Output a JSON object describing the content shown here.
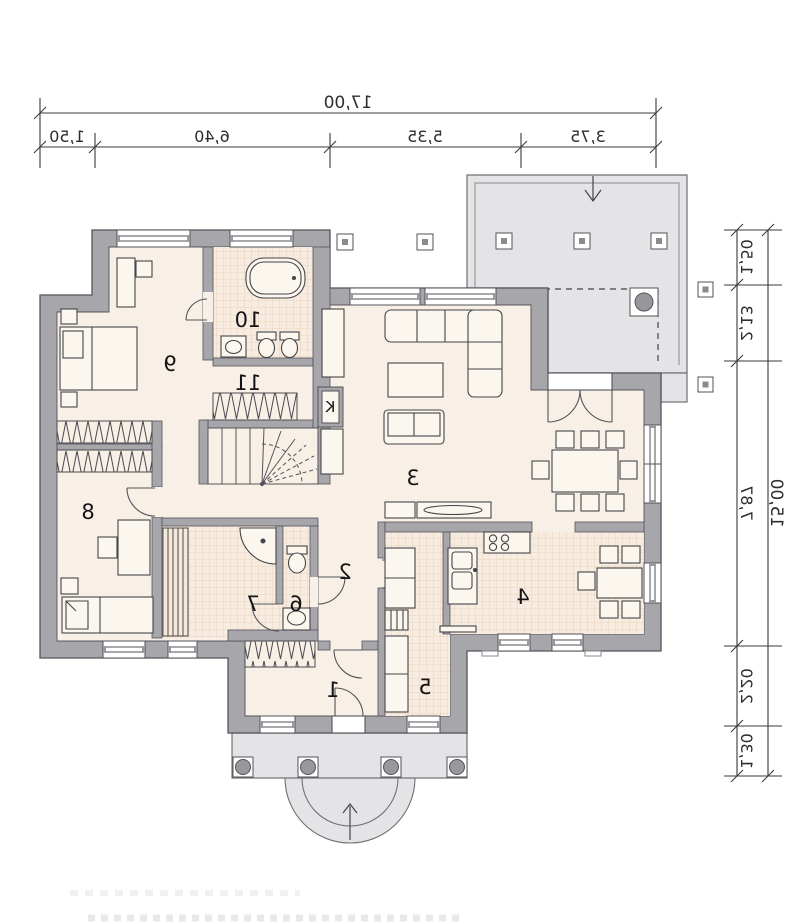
{
  "plan": {
    "type": "house-floor-plan",
    "mirrored": true,
    "rooms": {
      "r1": "1",
      "r2": "2",
      "r3": "3",
      "r4": "4",
      "r5": "5",
      "r6": "6",
      "r7": "7",
      "r8": "8",
      "r9": "9",
      "r10": "10",
      "r11": "11",
      "fireplace": "K"
    },
    "dims": {
      "top_total": "17,00",
      "top_1": "1,50",
      "top_2": "6,40",
      "top_3": "5,35",
      "top_4": "3,75",
      "right_total": "15,00",
      "right_1": "1,50",
      "right_2": "2,13",
      "right_3": "7,87",
      "right_4": "2,20",
      "right_5": "1,30"
    },
    "icons": [
      "terrace-entry-arrow",
      "porch-entry-arrow"
    ],
    "colors": {
      "wall": "#a6a6ab",
      "wall_edge": "#53535a",
      "floor": "#f8f0e7",
      "tile": "#f7ecdf",
      "tile_grid": "#e5cbb1",
      "terrace": "#e4e4e6",
      "furniture_stroke": "#45454a",
      "dimension": "#2e2e32"
    }
  }
}
